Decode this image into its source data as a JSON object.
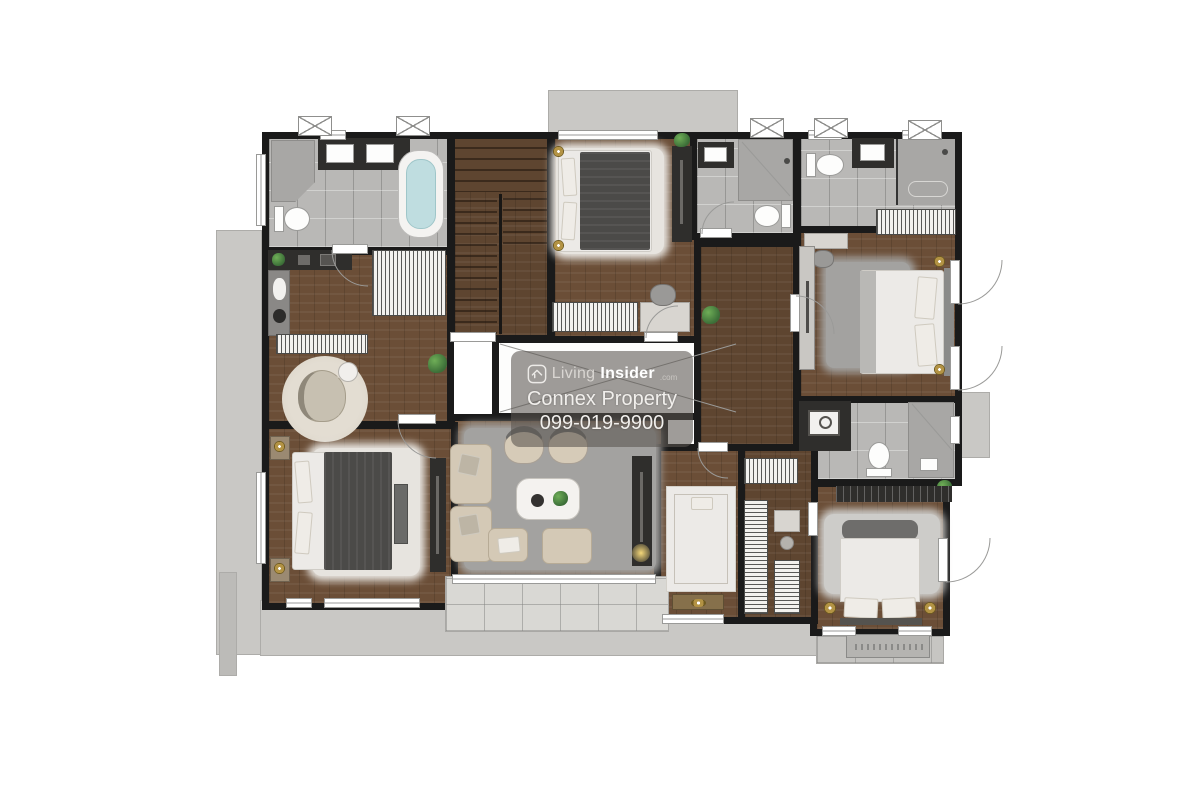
{
  "watermark": {
    "brand_living": "Living",
    "brand_insider": "Insider",
    "brand_tld": ".com",
    "line2": "Connex Property",
    "line3": "099-019-9900"
  },
  "colors": {
    "wall": "#1a1a1a",
    "wood": "#6b4e37",
    "wood_dark": "#5e4530",
    "wood_light": "#74573e",
    "tile": "#b9b8b6",
    "tile_dark": "#a8a7a5",
    "terrace": "#c9c8c5",
    "balcony": "#d9d8d4",
    "rug_light": "#e7e4df",
    "rug_gray": "#a3a2a0",
    "sofa": "#d4c9b6",
    "sofa_border": "#b2a788",
    "bed_dark": "#4b4a48",
    "bed_white": "#eceae7",
    "gold": "#b39344",
    "plant": "#3c6e38",
    "tub": "#bfdde0",
    "dark_cab": "#2f2e2c",
    "line": "#9a9a98",
    "wm_bg": "rgba(90,84,80,0.58)",
    "wm_text": "#f1efec"
  }
}
